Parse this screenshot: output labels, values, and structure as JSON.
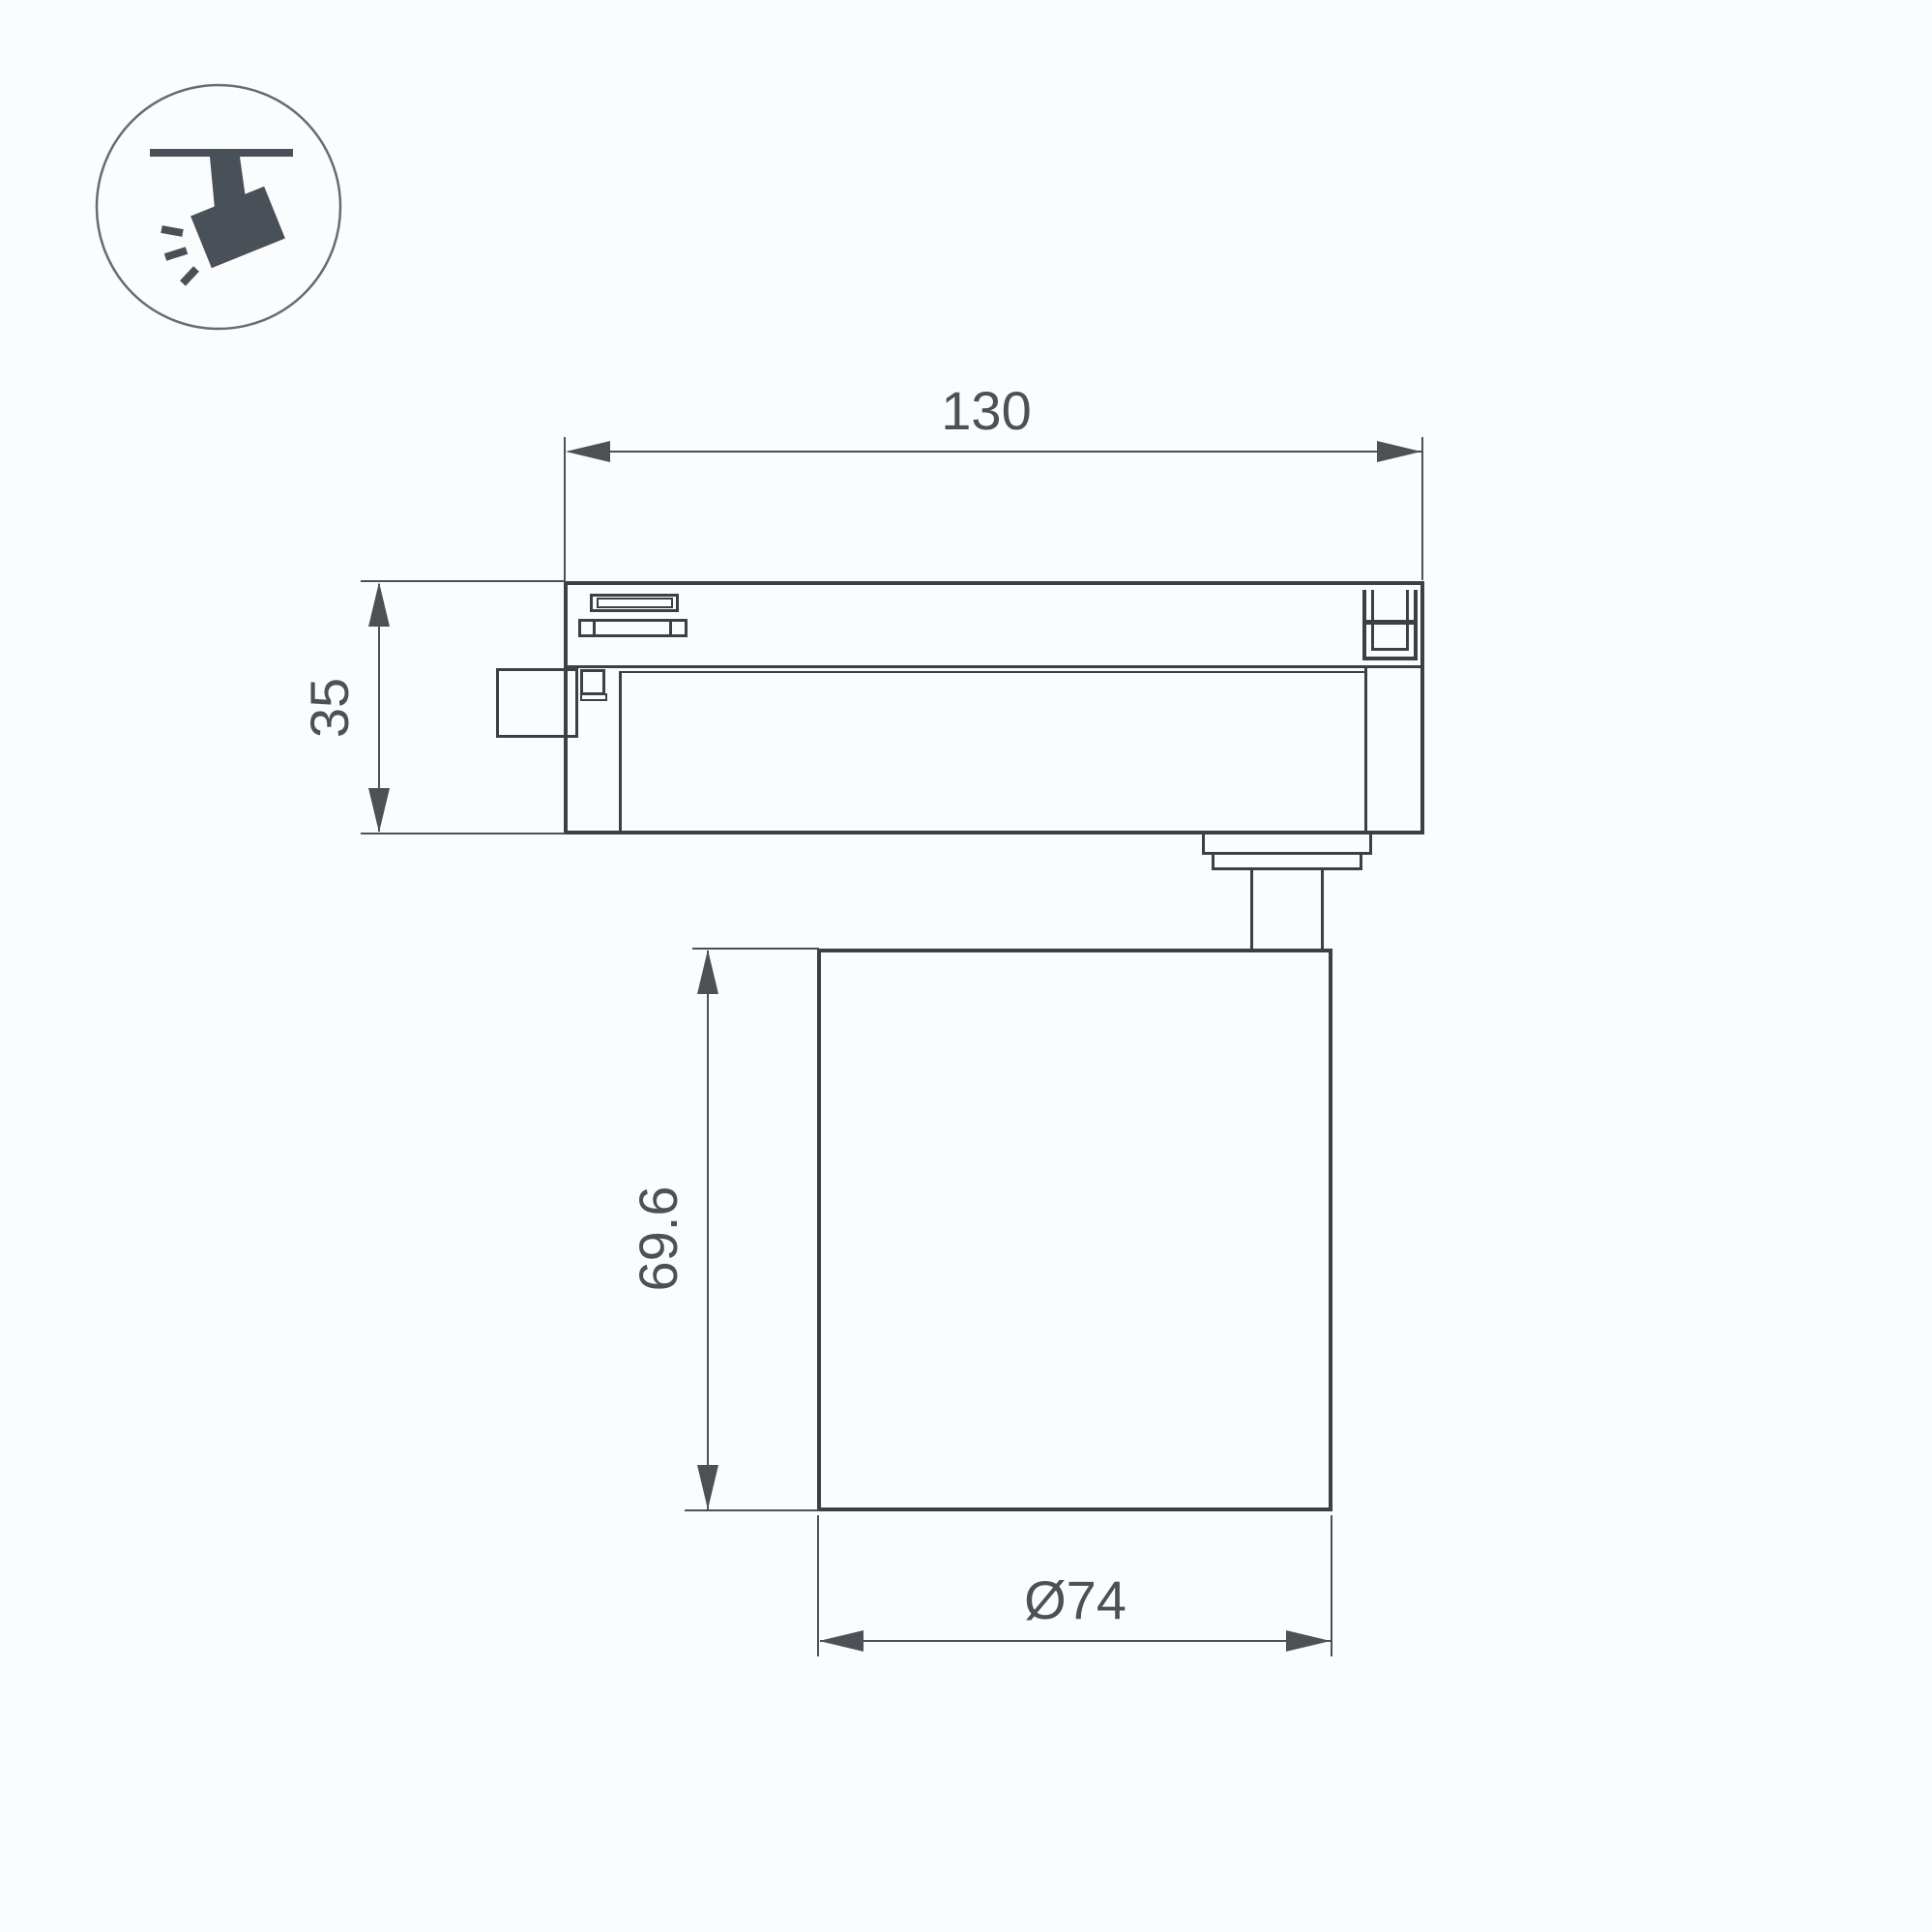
{
  "drawing": {
    "type": "technical-dimension-drawing",
    "icon": {
      "name": "track-spotlight-icon"
    },
    "dimensions": {
      "track_width": {
        "label": "130"
      },
      "adapter_height": {
        "label": "35"
      },
      "body_height": {
        "label": "69.6"
      },
      "body_diameter": {
        "label": "Ø74"
      }
    },
    "colors": {
      "line": "#3a4045",
      "dimension": "#4c5156",
      "icon": "#4a5057",
      "background": "#fbfcfd"
    }
  }
}
